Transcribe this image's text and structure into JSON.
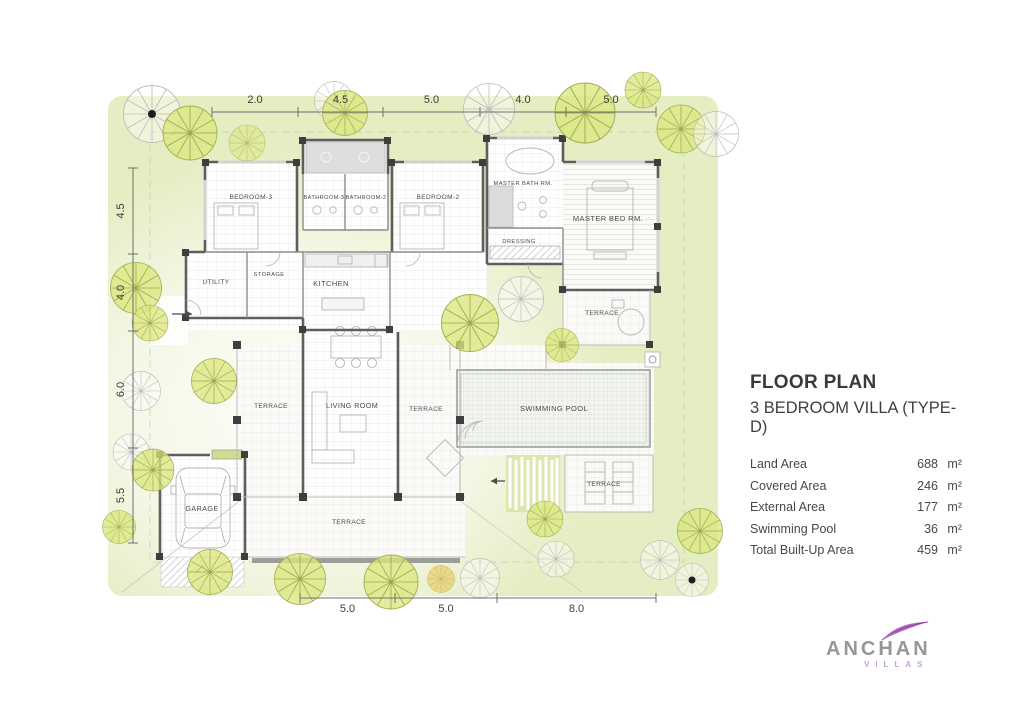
{
  "panel": {
    "title": "FLOOR PLAN",
    "subtitle": "3 BEDROOM VILLA (TYPE-D)",
    "areas": [
      {
        "label": "Land Area",
        "value": "688",
        "unit": "m²"
      },
      {
        "label": "Covered Area",
        "value": "246",
        "unit": "m²"
      },
      {
        "label": "External Area",
        "value": "177",
        "unit": "m²"
      },
      {
        "label": "Swimming Pool",
        "value": "36",
        "unit": "m²"
      },
      {
        "label": "Total Built-Up Area",
        "value": "459",
        "unit": "m²"
      }
    ]
  },
  "plan": {
    "rooms": {
      "bedroom3": "BEDROOM-3",
      "bathroom3": "BATHROOM-3",
      "bathroom2": "BATHROOM-2",
      "bedroom2": "BEDROOM-2",
      "master_bath": "MASTER BATH RM.",
      "dressing": "DRESSING",
      "master_bed": "MASTER BED RM.",
      "utility": "UTILITY",
      "storage": "STORAGE",
      "kitchen": "KITCHEN",
      "living": "LIVING ROOM",
      "terrace_left": "TERRACE",
      "terrace_right": "TERRACE",
      "terrace_master": "TERRACE",
      "terrace_pool": "TERRACE",
      "terrace_bottom": "TERRACE",
      "pool": "SWIMMING POOL",
      "garage": "GARAGE"
    },
    "dims": {
      "top": [
        "2.0",
        "4.5",
        "5.0",
        "4.0",
        "5.0"
      ],
      "left": [
        "4.5",
        "4.0",
        "6.0",
        "5.5"
      ],
      "bottom": [
        "5.0",
        "5.0",
        "8.0"
      ]
    }
  },
  "logo": {
    "name": "ANCHAN",
    "sub": "VILLAS"
  }
}
